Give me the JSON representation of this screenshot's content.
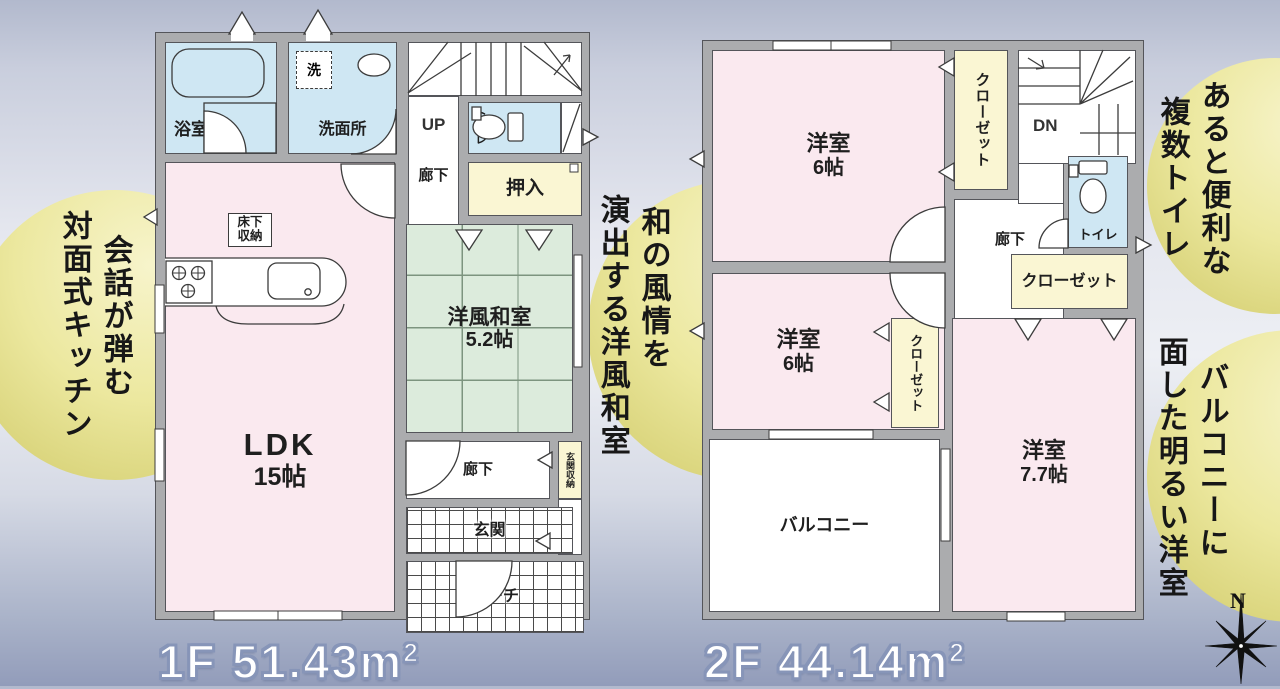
{
  "floor1": {
    "area": {
      "main": "1F 51.43m",
      "sup": "2"
    },
    "rooms": {
      "bath": "浴室",
      "laundry": "洗",
      "washroom": "洗面所",
      "up": "UP",
      "toilet": "トイレ",
      "hallway_upper": "廊下",
      "oshiire": "押入",
      "washitsu_name": "洋風和室",
      "washitsu_size": "5.2帖",
      "underfloor_storage": "床下収納",
      "ldk_name": "LDK",
      "ldk_size": "15帖",
      "hallway_lower": "廊下",
      "genkan_storage": "玄関収納",
      "genkan": "玄関",
      "porch": "ポーチ"
    }
  },
  "floor2": {
    "area": {
      "main": "2F 44.14m",
      "sup": "2"
    },
    "rooms": {
      "bedroom1_name": "洋室",
      "bedroom1_size": "6帖",
      "closet1": "クローゼット",
      "dn": "DN",
      "hallway": "廊下",
      "toilet": "トイレ",
      "closet2": "クローゼット",
      "bedroom2_name": "洋室",
      "bedroom2_size": "6帖",
      "closet3": "クローゼット",
      "balcony": "バルコニー",
      "bedroom3_name": "洋室",
      "bedroom3_size": "7.7帖"
    }
  },
  "annotations": {
    "kitchen": {
      "col1": "会話が弾む",
      "col2": "対面式キッチン"
    },
    "washitsu": {
      "col1": "和の風情を",
      "col2": "演出する洋風和室"
    },
    "toilets": {
      "col1": "あると便利な",
      "col2": "複数トイレ"
    },
    "bedroom": {
      "col1": "バルコニーに",
      "col2": "面した明るい洋室"
    }
  },
  "compass": {
    "north": "N"
  },
  "colors": {
    "room_pink": "#fae9ef",
    "room_blue": "#cfe7f3",
    "room_green": "#dcebdc",
    "room_yellow": "#faf6d3",
    "wall_gray": "#abacae",
    "highlight_yellow": "#d0ca69",
    "area_label_outline": "#8795b8"
  }
}
